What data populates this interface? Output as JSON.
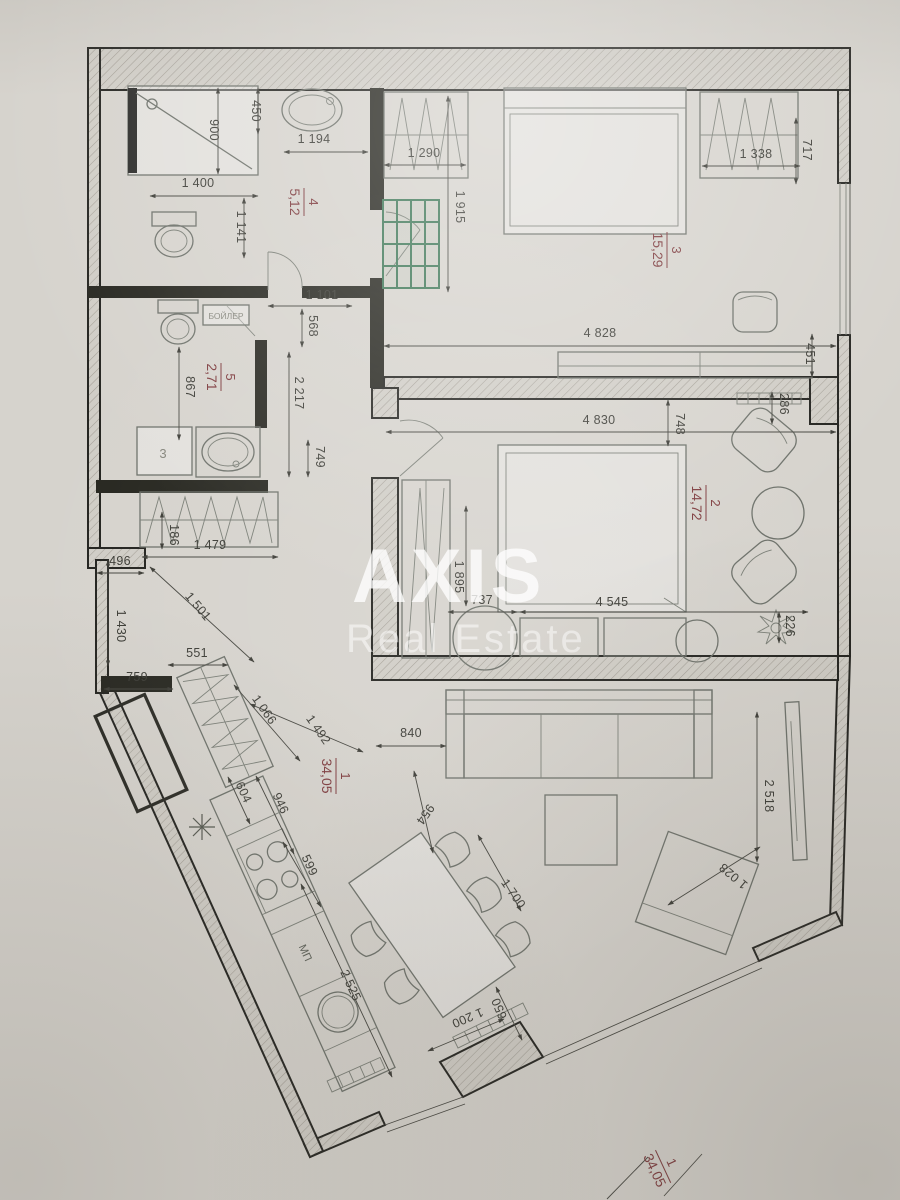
{
  "watermark": {
    "brand": "AXIS",
    "subtitle": "Real Estate"
  },
  "rooms": [
    {
      "num": "1",
      "area": "34,05"
    },
    {
      "num": "2",
      "area": "14,72"
    },
    {
      "num": "3",
      "area": "15,29"
    },
    {
      "num": "4",
      "area": "5,12"
    },
    {
      "num": "5",
      "area": "2,71"
    },
    {
      "num": "1",
      "area": "34,05"
    }
  ],
  "annotations": {
    "boiler_label": "БОЙЛЕР",
    "appliance_label": "3",
    "kitchen_label": "МП"
  },
  "dims": [
    "450",
    "900",
    "1 194",
    "1 400",
    "1 141",
    "1 290",
    "1 915",
    "1 338",
    "717",
    "1 101",
    "568",
    "2 217",
    "749",
    "867",
    "4 828",
    "4 830",
    "451",
    "286",
    "748",
    "226",
    "4 545",
    "737",
    "1 895",
    "2 518",
    "1 028",
    "1 479",
    "186",
    "496",
    "1 430",
    "1 501",
    "551",
    "759",
    "1 066",
    "1 492",
    "840",
    "954",
    "1 700",
    "604",
    "946",
    "599",
    "2 525",
    "650",
    "1 200"
  ],
  "colors": {
    "wall": "#26261f",
    "dimension_text": "#3b3b35",
    "room_label": "#7c383b",
    "cabinet_green": "#3e7757",
    "paper": "#d6d3cd",
    "watermark": "#ffffff"
  }
}
